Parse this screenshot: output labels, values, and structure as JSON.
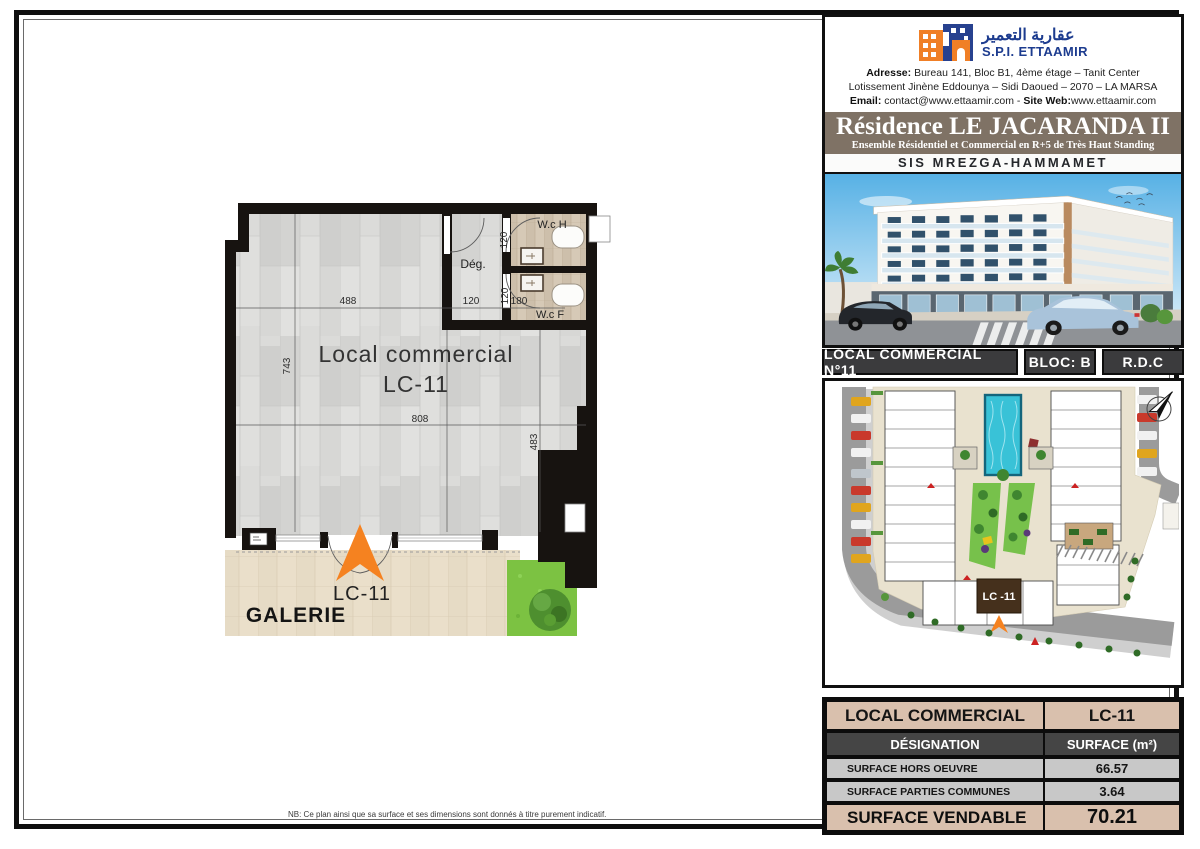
{
  "colors": {
    "banner_taupe": "#7f7265",
    "bar_gray": "#3b3b3d",
    "table_tan": "#d9c0ad",
    "table_dark": "#454545",
    "table_gray": "#c8c8c8",
    "entrance_orange": "#f58220",
    "brand_blue": "#1d3c8f",
    "pool_teal": "#39c2d7"
  },
  "header": {
    "arabic": "عقارية التعمير",
    "company": "S.P.I. ETTAAMIR",
    "address_label": "Adresse:",
    "address_value": "Bureau 141, Bloc B1, 4ème étage – Tanit Center",
    "address_line2": "Lotissement Jinène Eddounya – Sidi Daoued – 2070 – LA MARSA",
    "email_label": "Email:",
    "email_value": "contact@www.ettaamir.com",
    "sep": " - ",
    "web_label": "Site Web:",
    "web_value": "www.ettaamir.com"
  },
  "banner": {
    "title": "Résidence LE JACARANDA II",
    "subtitle": "Ensemble Résidentiel et Commercial en R+5 de Très Haut Standing",
    "location": "SIS MREZGA-HAMMAMET"
  },
  "unit_bar": {
    "local": "LOCAL COMMERCIAL N°11",
    "bloc": "BLOC: B",
    "floor": "R.D.C"
  },
  "floor_plan": {
    "room_label_line1": "Local commercial",
    "room_label_line2": "LC-11",
    "wc_h": "W.c H",
    "wc_f": "W.c F",
    "deg": "Dég.",
    "dims": {
      "d488": "488",
      "d120_deg": "120",
      "d180": "180",
      "d120_wch": "120",
      "d120_wcf": "120",
      "d808": "808",
      "d743": "743",
      "d483": "483"
    },
    "entrance_label": "LC-11",
    "galerie_label": "GALERIE"
  },
  "site_plan": {
    "lc_label": "LC -11"
  },
  "table": {
    "title_left": "LOCAL COMMERCIAL",
    "title_right": "LC-11",
    "header_left": "DÉSIGNATION",
    "header_right": "SURFACE (m²)",
    "rows": [
      {
        "label": "SURFACE HORS OEUVRE",
        "value": "66.57"
      },
      {
        "label": "SURFACE PARTIES COMMUNES",
        "value": "3.64"
      }
    ],
    "footer_label": "SURFACE VENDABLE",
    "footer_value": "70.21"
  },
  "note": "NB: Ce plan ainsi que sa surface et ses dimensions sont donnés à titre purement indicatif."
}
